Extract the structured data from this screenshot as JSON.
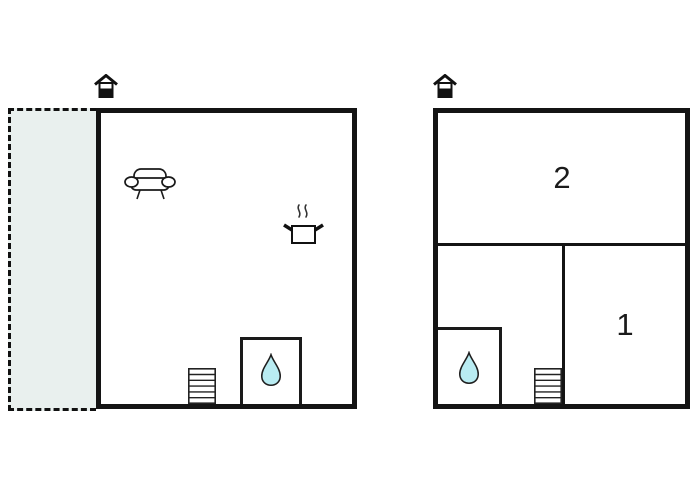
{
  "canvas": {
    "width": 700,
    "height": 500,
    "background": "#ffffff",
    "type": "floor-plan"
  },
  "colors": {
    "wall": "#141414",
    "terrace_fill": "#e9f0ee",
    "water_drop_fill": "#b9ecf2",
    "icon_stroke": "#1a1a1a"
  },
  "left_plan": {
    "terrace": {
      "style": "dashed-outline"
    },
    "icons": [
      {
        "name": "house-entrance-icon"
      },
      {
        "name": "sofa-icon"
      },
      {
        "name": "cooking-pot-icon"
      },
      {
        "name": "stairs-icon"
      },
      {
        "name": "water-drop-icon"
      }
    ]
  },
  "right_plan": {
    "rooms": [
      {
        "label": "2"
      },
      {
        "label": "1"
      }
    ],
    "icons": [
      {
        "name": "house-entrance-icon"
      },
      {
        "name": "water-drop-icon"
      },
      {
        "name": "stairs-icon"
      }
    ]
  }
}
